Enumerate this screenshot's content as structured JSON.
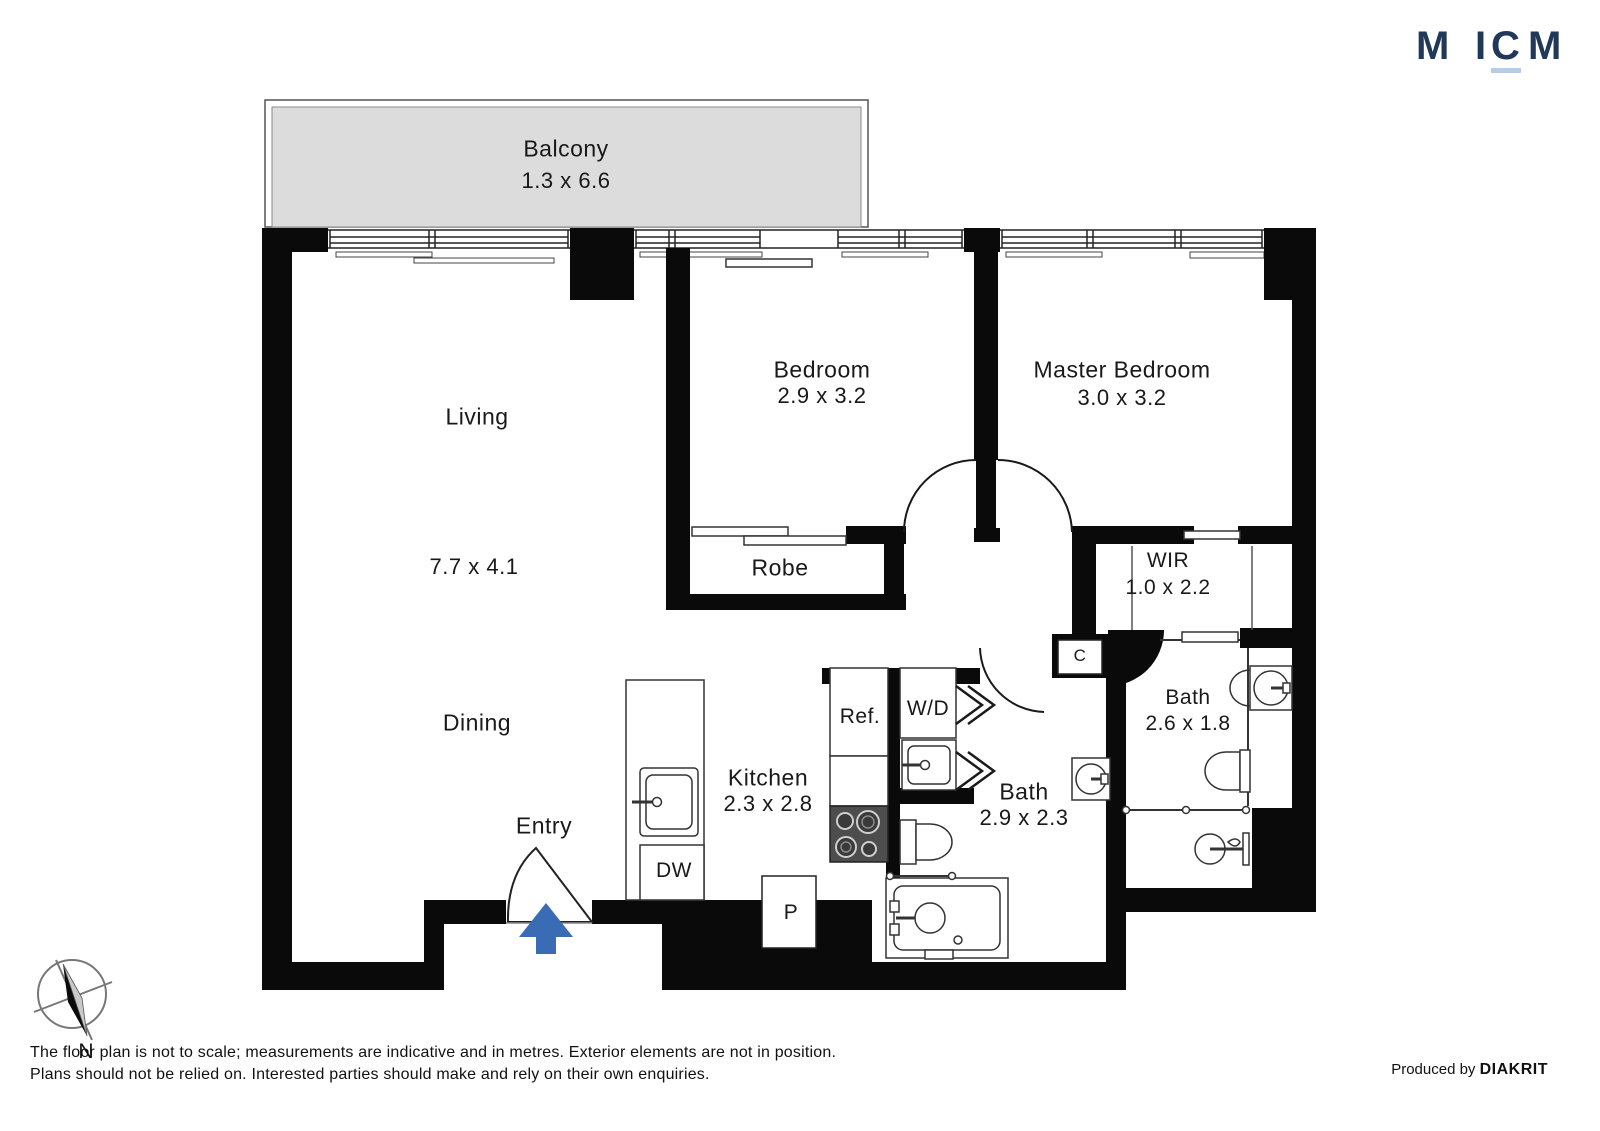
{
  "logo": {
    "letters": [
      "M",
      "I",
      "C",
      "M"
    ]
  },
  "rooms": {
    "balcony": {
      "name": "Balcony",
      "dims": "1.3 x 6.6"
    },
    "living": {
      "name": "Living",
      "dims": "7.7 x 4.1"
    },
    "dining": {
      "name": "Dining"
    },
    "entry": {
      "name": "Entry"
    },
    "bedroom": {
      "name": "Bedroom",
      "dims": "2.9 x 3.2"
    },
    "master": {
      "name": "Master Bedroom",
      "dims": "3.0 x 3.2"
    },
    "robe": {
      "name": "Robe"
    },
    "wir": {
      "name": "WIR",
      "dims": "1.0 x 2.2"
    },
    "bath_ensuite": {
      "name": "Bath",
      "dims": "2.6 x 1.8"
    },
    "bath_main": {
      "name": "Bath",
      "dims": "2.9 x 2.3"
    },
    "kitchen": {
      "name": "Kitchen",
      "dims": "2.3 x 2.8"
    }
  },
  "fixtures": {
    "fridge": "Ref.",
    "washer_dryer": "W/D",
    "dishwasher": "DW",
    "pantry": "P",
    "cupboard": "C"
  },
  "compass": {
    "north_label": "N"
  },
  "footer": {
    "disclaimer_line1": "The floor plan is not to scale; measurements are indicative and in metres. Exterior elements are not in position.",
    "disclaimer_line2": "Plans should not be relied on. Interested parties should make and rely on their own enquiries.",
    "produced_by": "Produced by",
    "producer": "DIAKRIT"
  },
  "colors": {
    "brand_navy": "#20395a",
    "brand_underline": "#b5cde8",
    "wall_black": "#0a0a0a",
    "balcony_fill": "#dcdcdc",
    "entry_arrow_blue": "#3a6cb5"
  }
}
